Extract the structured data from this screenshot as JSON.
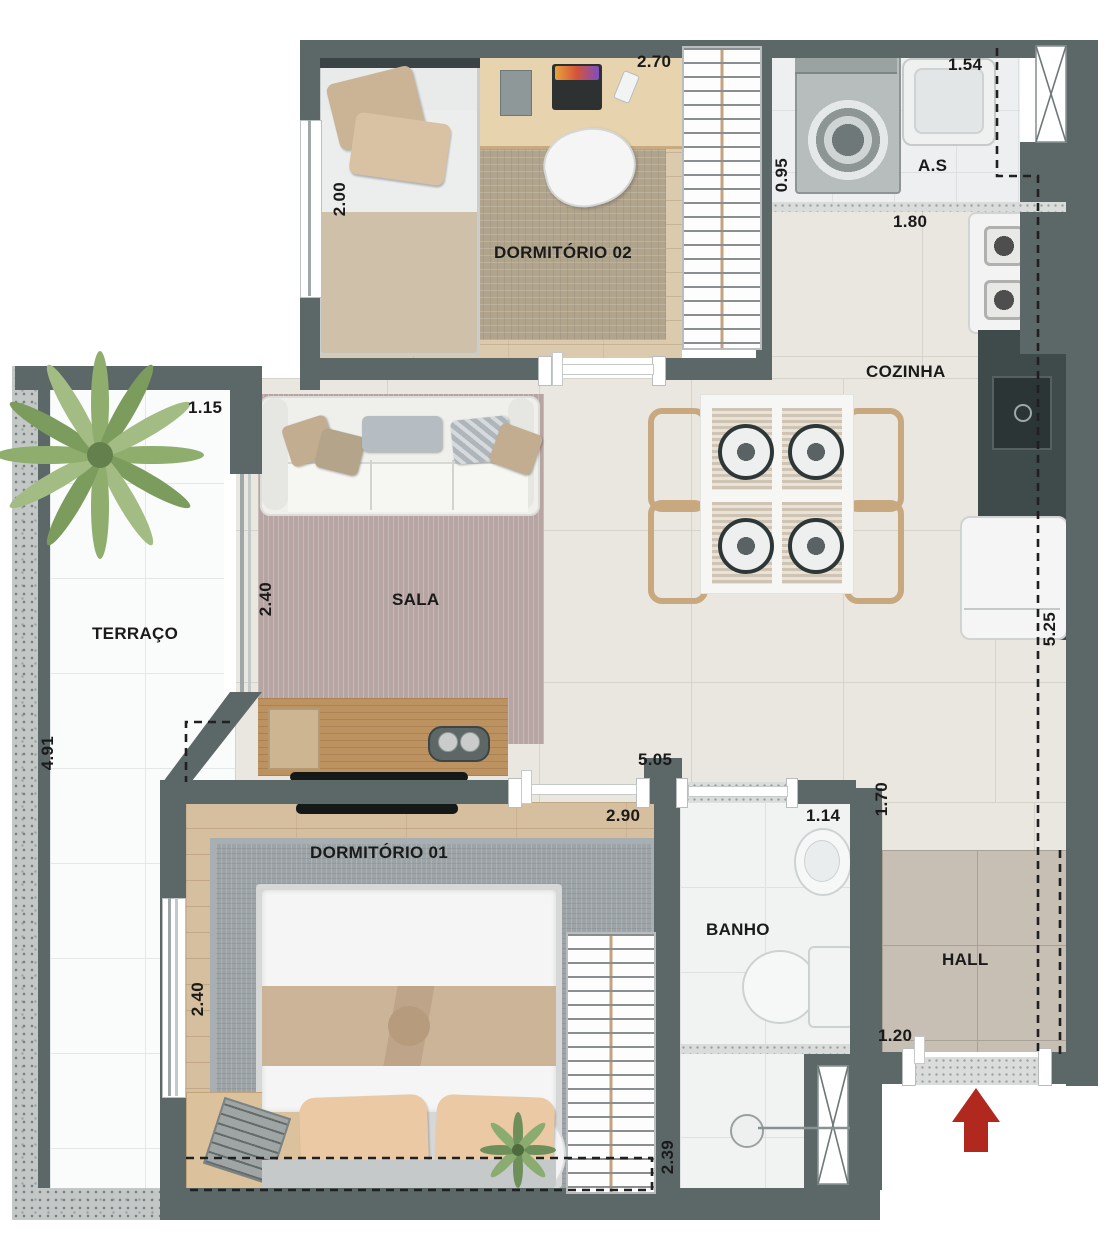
{
  "plan_title": "Apartment floor plan (top view)",
  "rooms": {
    "dormitorio02": {
      "name": "DORMITÓRIO 02",
      "width_m": "2.70",
      "depth_m": "2.00"
    },
    "area_servico": {
      "name": "A.S",
      "width_m": "1.54",
      "depth_m": "0.95"
    },
    "cozinha": {
      "name": "COZINHA",
      "width_m": "1.80",
      "length_m": "5.25"
    },
    "terraco": {
      "name": "TERRAÇO",
      "width_m": "1.15",
      "depth_m": "4.91"
    },
    "sala": {
      "name": "SALA",
      "depth_m": "2.40",
      "span_m": "5.05"
    },
    "dormitorio01": {
      "name": "DORMITÓRIO 01",
      "width_m": "2.90",
      "depth_m": "2.40"
    },
    "banho": {
      "name": "BANHO",
      "width_m": "1.14",
      "depth_m": "2.39"
    },
    "hall": {
      "name": "HALL",
      "depth_m": "1.70",
      "entry_width_m": "1.20"
    }
  },
  "colors": {
    "wall": "#5c6868",
    "counter": "#3f4a4b",
    "entry_arrow": "#b1281e",
    "annotation": "#1a1a1a"
  },
  "icons": {
    "entrance-arrow": "red ▲ pointing into the unit",
    "palm-plant": "top-view palm on terrace",
    "window-x": "crossed white window symbol",
    "door": "white door leaf in wall opening"
  },
  "furniture": [
    "single-bed",
    "desk-with-laptop",
    "desk-chair",
    "wardrobe",
    "washing-machine",
    "laundry-tank",
    "stove",
    "kitchen-sink",
    "fridge",
    "dining-table-4-places",
    "sofa",
    "tv-console",
    "tv",
    "double-bed",
    "nightstand",
    "side-table-plant",
    "toilet",
    "bathroom-sink",
    "shower-drain"
  ]
}
